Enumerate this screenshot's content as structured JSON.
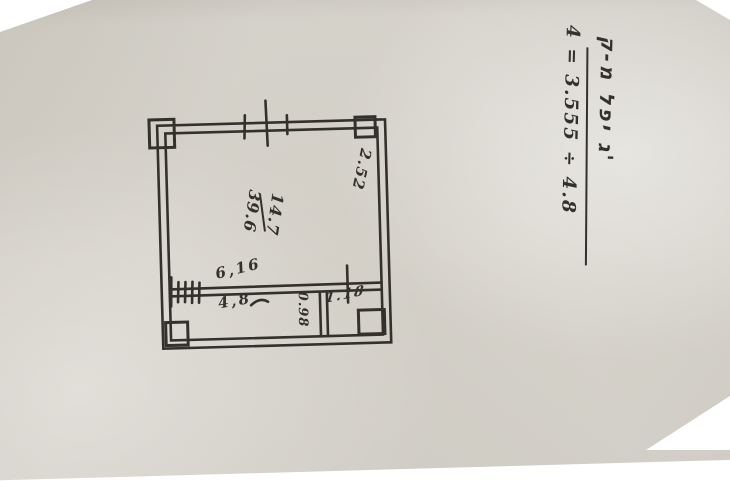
{
  "colors": {
    "paper": "#d8d5ce",
    "ink": "#33312b",
    "photo_border": "#ffffff"
  },
  "plan": {
    "room_label": {
      "numerator": "14.7",
      "denominator": "39.6"
    },
    "dims": {
      "right_wall": "2.52",
      "above_wall": "6,16",
      "below_wall": "4,8",
      "closet": "0.98",
      "small_room": "1.18"
    }
  },
  "note": {
    "title": "ק-מ לפי ג'",
    "formula": "4 = 3.555 ÷ 4.8"
  }
}
